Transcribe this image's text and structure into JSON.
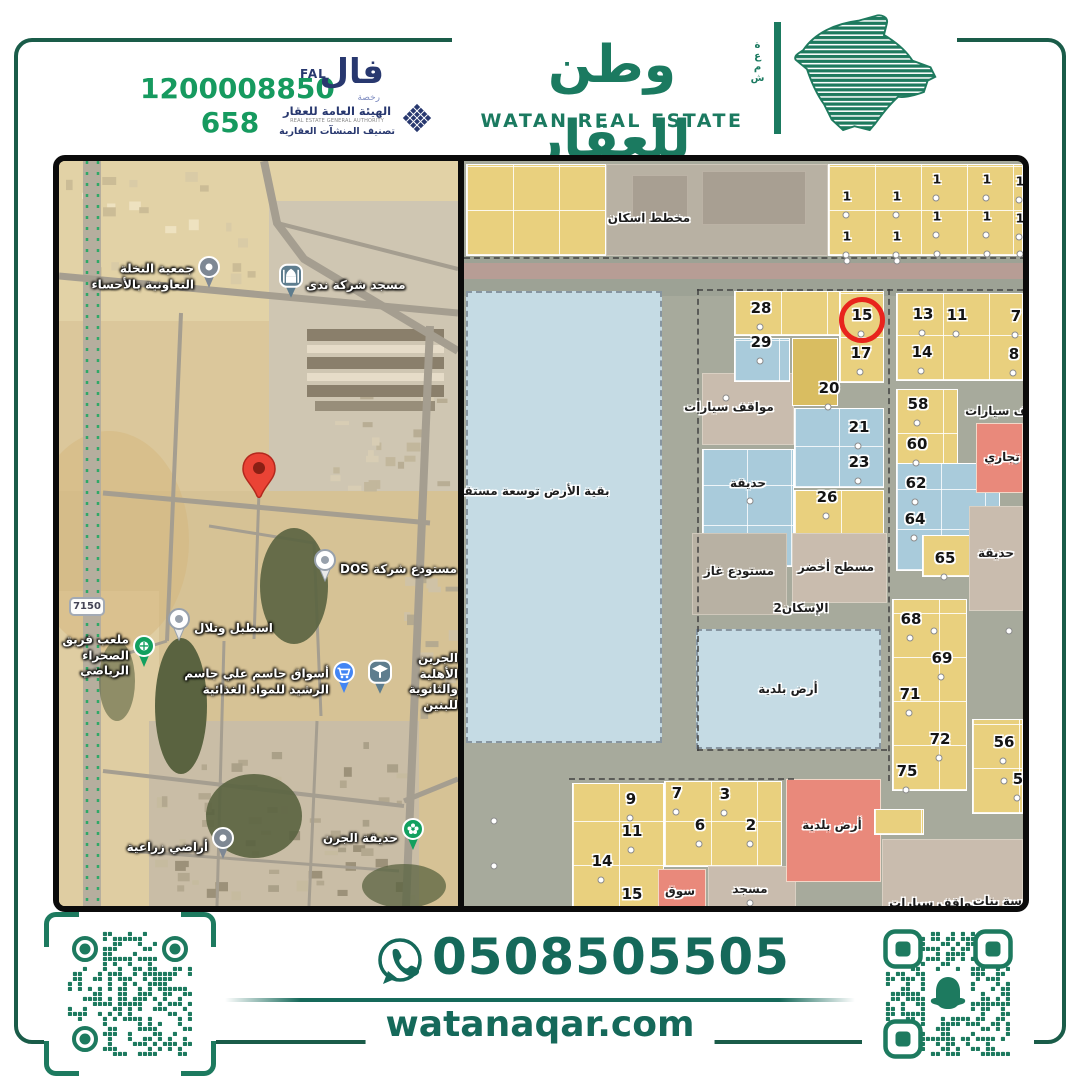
{
  "palette": {
    "brand_green": "#1b7a60",
    "frame_green": "#1a5c49",
    "license_green": "#169a5f",
    "navy": "#28386f",
    "qr_green": "#1d7a5f",
    "red_circle": "#e8241d",
    "pin_red": "#ea4335",
    "plot_yellow": "#e9d07e",
    "plot_blue": "#a9cbdb",
    "plot_red": "#e9897b",
    "block_beige": "#c9bcae",
    "block_grey": "#b8b1a3",
    "future_blue": "#c5dbe4",
    "map_road": "#a7aa9c"
  },
  "header": {
    "license_number": "1200008850",
    "record_number": "658",
    "fal_ar": "فال",
    "fal_en": "FAL",
    "fal_license_word": "رخصة",
    "authority_ar": "الهيئة العامة للعقار",
    "authority_en": "REAL ESTATE GENERAL AUTHORITY",
    "authority_classification": "تصنيف المنشآت العقارية",
    "brand_ar": "وطن للعقار",
    "brand_en": "WATAN REAL ESTATE",
    "brand_side_vertical": "شمعة"
  },
  "contact": {
    "phone": "0508505505",
    "website": "watanaqar.com"
  },
  "left_map": {
    "road_badge": "7150",
    "pois": [
      {
        "type": "pin-grey",
        "x": 150,
        "y": 116,
        "side": "left",
        "lines": [
          "جمعية النخلة",
          "التعاونية بالأحساء"
        ]
      },
      {
        "type": "mosque",
        "x": 232,
        "y": 125,
        "side": "right",
        "lines": [
          "مسجد شركة ندى"
        ]
      },
      {
        "type": "red-pin",
        "x": 200,
        "y": 338,
        "side": "none",
        "lines": []
      },
      {
        "type": "pin-white",
        "x": 266,
        "y": 409,
        "side": "right",
        "lines": [
          "مستودع شركة DOS"
        ]
      },
      {
        "type": "pin-white",
        "x": 120,
        "y": 468,
        "side": "right",
        "lines": [
          "اسطبل وتلال"
        ]
      },
      {
        "type": "stadium",
        "x": 85,
        "y": 495,
        "side": "left",
        "lines": [
          "ملعب فريق",
          "الصحراء الرياضي"
        ]
      },
      {
        "type": "cart",
        "x": 285,
        "y": 521,
        "side": "left",
        "lines": [
          "أسواق جاسم علي جاسم",
          "الرشيد للمواد الغذائية"
        ]
      },
      {
        "type": "school",
        "x": 321,
        "y": 521,
        "side": "right",
        "lines": [
          "الجرين الأهلية",
          "والثانوية للبنين"
        ]
      },
      {
        "type": "pin-grey",
        "x": 164,
        "y": 687,
        "side": "left",
        "lines": [
          "أراضي زراعية"
        ]
      },
      {
        "type": "park",
        "x": 354,
        "y": 678,
        "side": "left",
        "lines": [
          "حديقة الجرن"
        ]
      }
    ]
  },
  "right_map": {
    "blocks": [
      {
        "x": 2,
        "y": 3,
        "w": 140,
        "h": 92,
        "c": "yellow"
      },
      {
        "x": 142,
        "y": 3,
        "w": 222,
        "h": 92,
        "c": "grey"
      },
      {
        "x": 168,
        "y": 14,
        "w": 56,
        "h": 46,
        "c": "greydark"
      },
      {
        "x": 238,
        "y": 10,
        "w": 104,
        "h": 54,
        "c": "greydark"
      },
      {
        "x": 364,
        "y": 3,
        "w": 195,
        "h": 92,
        "c": "yellow"
      },
      {
        "x": 0,
        "y": 95,
        "w": 559,
        "h": 40,
        "c": "road"
      },
      {
        "x": 0,
        "y": 102,
        "w": 559,
        "h": 16,
        "c": "roadpink"
      },
      {
        "x": 2,
        "y": 130,
        "w": 196,
        "h": 452,
        "c": "lightblue"
      },
      {
        "x": 238,
        "y": 212,
        "w": 92,
        "h": 72,
        "c": "beige"
      },
      {
        "x": 238,
        "y": 288,
        "w": 92,
        "h": 118,
        "c": "blue"
      },
      {
        "x": 270,
        "y": 130,
        "w": 150,
        "h": 45,
        "c": "yellow"
      },
      {
        "x": 270,
        "y": 177,
        "w": 56,
        "h": 44,
        "c": "blue"
      },
      {
        "x": 375,
        "y": 130,
        "w": 45,
        "h": 92,
        "c": "yellow"
      },
      {
        "x": 328,
        "y": 177,
        "w": 46,
        "h": 68,
        "c": "yellowdark"
      },
      {
        "x": 330,
        "y": 247,
        "w": 90,
        "h": 80,
        "c": "blue"
      },
      {
        "x": 330,
        "y": 329,
        "w": 90,
        "h": 46,
        "c": "yellow"
      },
      {
        "x": 432,
        "y": 132,
        "w": 127,
        "h": 88,
        "c": "yellow"
      },
      {
        "x": 432,
        "y": 228,
        "w": 62,
        "h": 90,
        "c": "yellow"
      },
      {
        "x": 432,
        "y": 302,
        "w": 104,
        "h": 108,
        "c": "blue"
      },
      {
        "x": 458,
        "y": 374,
        "w": 48,
        "h": 42,
        "c": "yellow"
      },
      {
        "x": 512,
        "y": 262,
        "w": 47,
        "h": 70,
        "c": "red"
      },
      {
        "x": 505,
        "y": 345,
        "w": 54,
        "h": 105,
        "c": "beige"
      },
      {
        "x": 228,
        "y": 372,
        "w": 95,
        "h": 82,
        "c": "grey"
      },
      {
        "x": 328,
        "y": 372,
        "w": 95,
        "h": 70,
        "c": "beige"
      },
      {
        "x": 232,
        "y": 468,
        "w": 185,
        "h": 120,
        "c": "lightblue"
      },
      {
        "x": 428,
        "y": 438,
        "w": 75,
        "h": 192,
        "c": "yellow"
      },
      {
        "x": 508,
        "y": 558,
        "w": 51,
        "h": 95,
        "c": "yellow"
      },
      {
        "x": 108,
        "y": 622,
        "w": 92,
        "h": 128,
        "c": "yellow"
      },
      {
        "x": 200,
        "y": 620,
        "w": 118,
        "h": 86,
        "c": "yellow"
      },
      {
        "x": 194,
        "y": 708,
        "w": 48,
        "h": 45,
        "c": "red"
      },
      {
        "x": 244,
        "y": 705,
        "w": 88,
        "h": 50,
        "c": "beige"
      },
      {
        "x": 322,
        "y": 618,
        "w": 95,
        "h": 103,
        "c": "red"
      },
      {
        "x": 410,
        "y": 648,
        "w": 50,
        "h": 26,
        "c": "yellow"
      },
      {
        "x": 418,
        "y": 678,
        "w": 141,
        "h": 77,
        "c": "beige"
      }
    ],
    "plot_numbers": [
      {
        "n": "1",
        "x": 383,
        "y": 35,
        "s": 1
      },
      {
        "n": "1",
        "x": 433,
        "y": 35,
        "s": 1
      },
      {
        "n": "1",
        "x": 473,
        "y": 18,
        "s": 1
      },
      {
        "n": "1",
        "x": 523,
        "y": 18,
        "s": 1
      },
      {
        "n": "1",
        "x": 556,
        "y": 20,
        "s": 1
      },
      {
        "n": "1",
        "x": 473,
        "y": 55,
        "s": 1
      },
      {
        "n": "1",
        "x": 523,
        "y": 55,
        "s": 1
      },
      {
        "n": "1",
        "x": 556,
        "y": 57,
        "s": 1
      },
      {
        "n": "1",
        "x": 383,
        "y": 75,
        "s": 1
      },
      {
        "n": "1",
        "x": 433,
        "y": 75,
        "s": 1
      },
      {
        "n": "28",
        "x": 297,
        "y": 147
      },
      {
        "n": "29",
        "x": 297,
        "y": 181
      },
      {
        "n": "15",
        "x": 398,
        "y": 154,
        "c": 1
      },
      {
        "n": "17",
        "x": 397,
        "y": 192
      },
      {
        "n": "20",
        "x": 365,
        "y": 227
      },
      {
        "n": "21",
        "x": 395,
        "y": 266
      },
      {
        "n": "23",
        "x": 395,
        "y": 301
      },
      {
        "n": "26",
        "x": 363,
        "y": 336
      },
      {
        "n": "13",
        "x": 459,
        "y": 153
      },
      {
        "n": "11",
        "x": 493,
        "y": 154
      },
      {
        "n": "7",
        "x": 552,
        "y": 155
      },
      {
        "n": "14",
        "x": 458,
        "y": 191
      },
      {
        "n": "8",
        "x": 550,
        "y": 193
      },
      {
        "n": "58",
        "x": 454,
        "y": 243
      },
      {
        "n": "60",
        "x": 453,
        "y": 283
      },
      {
        "n": "62",
        "x": 452,
        "y": 322
      },
      {
        "n": "64",
        "x": 451,
        "y": 358
      },
      {
        "n": "65",
        "x": 481,
        "y": 397
      },
      {
        "n": "68",
        "x": 447,
        "y": 458
      },
      {
        "n": "69",
        "x": 478,
        "y": 497
      },
      {
        "n": "71",
        "x": 446,
        "y": 533
      },
      {
        "n": "72",
        "x": 476,
        "y": 578
      },
      {
        "n": "75",
        "x": 443,
        "y": 610
      },
      {
        "n": "56",
        "x": 540,
        "y": 581
      },
      {
        "n": "5",
        "x": 554,
        "y": 618
      },
      {
        "n": "9",
        "x": 167,
        "y": 638
      },
      {
        "n": "11",
        "x": 168,
        "y": 670
      },
      {
        "n": "14",
        "x": 138,
        "y": 700
      },
      {
        "n": "15",
        "x": 168,
        "y": 733
      },
      {
        "n": "7",
        "x": 213,
        "y": 632
      },
      {
        "n": "3",
        "x": 261,
        "y": 633
      },
      {
        "n": "6",
        "x": 236,
        "y": 664
      },
      {
        "n": "2",
        "x": 287,
        "y": 664
      }
    ],
    "area_labels": [
      {
        "t": "مخطط اسكان",
        "x": 185,
        "y": 57
      },
      {
        "t": "بقية الأرض توسعة مستقبلية",
        "x": 62,
        "y": 330
      },
      {
        "t": "مواقف سيارات",
        "x": 265,
        "y": 246
      },
      {
        "t": "حديقة",
        "x": 284,
        "y": 322
      },
      {
        "t": "مواقف سيارات",
        "x": 546,
        "y": 250
      },
      {
        "t": "تجاري",
        "x": 538,
        "y": 296
      },
      {
        "t": "حديقة",
        "x": 532,
        "y": 392
      },
      {
        "t": "مستودع غاز",
        "x": 275,
        "y": 410
      },
      {
        "t": "مسطح أخضر",
        "x": 372,
        "y": 406
      },
      {
        "t": "الإسكان2",
        "x": 337,
        "y": 447
      },
      {
        "t": "أرض بلدية",
        "x": 324,
        "y": 528
      },
      {
        "t": "أرض بلدية",
        "x": 368,
        "y": 664
      },
      {
        "t": "سوق",
        "x": 216,
        "y": 730
      },
      {
        "t": "مسجد",
        "x": 286,
        "y": 728
      },
      {
        "t": "مواقف سيارات",
        "x": 470,
        "y": 742
      },
      {
        "t": "مدرسة بنات",
        "x": 544,
        "y": 740
      }
    ],
    "extra_dots": [
      [
        383,
        100
      ],
      [
        433,
        100
      ],
      [
        473,
        93
      ],
      [
        523,
        93
      ],
      [
        556,
        93
      ],
      [
        262,
        237
      ],
      [
        286,
        340
      ],
      [
        470,
        470
      ],
      [
        540,
        620
      ],
      [
        286,
        742
      ],
      [
        552,
        300
      ],
      [
        545,
        470
      ],
      [
        30,
        660
      ],
      [
        30,
        705
      ]
    ]
  }
}
